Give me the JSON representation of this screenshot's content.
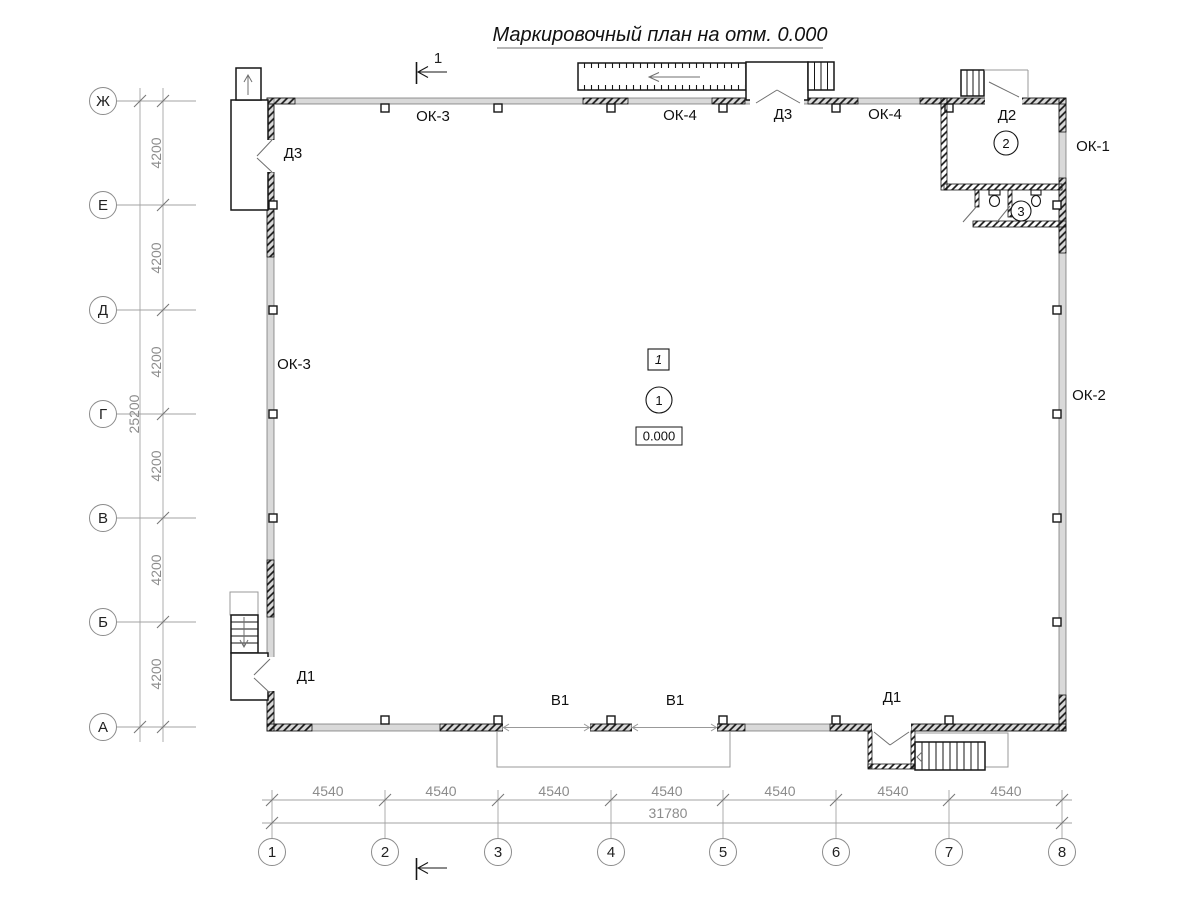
{
  "title": "Маркировочный план на отм. 0.000",
  "colors": {
    "ink": "#161616",
    "dim_gray": "#8c8c8c",
    "wall_fill": "#d9d9d9"
  },
  "axes": {
    "rows": [
      {
        "label": "Ж"
      },
      {
        "label": "Е"
      },
      {
        "label": "Д"
      },
      {
        "label": "Г"
      },
      {
        "label": "В"
      },
      {
        "label": "Б"
      },
      {
        "label": "А"
      }
    ],
    "cols": [
      {
        "label": "1"
      },
      {
        "label": "2"
      },
      {
        "label": "3"
      },
      {
        "label": "4"
      },
      {
        "label": "5"
      },
      {
        "label": "6"
      },
      {
        "label": "7"
      },
      {
        "label": "8"
      }
    ]
  },
  "dims": {
    "row_segments": [
      "4200",
      "4200",
      "4200",
      "4200",
      "4200",
      "4200"
    ],
    "row_total": "25200",
    "col_segments": [
      "4540",
      "4540",
      "4540",
      "4540",
      "4540",
      "4540",
      "4540"
    ],
    "col_total": "31780"
  },
  "labels": {
    "ok3_top": "ОК-3",
    "ok4_top_left": "ОК-4",
    "d3_top": "Д3",
    "ok4_top_right": "ОК-4",
    "d2": "Д2",
    "ok1": "ОК-1",
    "ok2": "ОК-2",
    "ok3_left": "ОК-3",
    "d3_left": "Д3",
    "d1_left": "Д1",
    "d1_bottom": "Д1",
    "v1_left": "В1",
    "v1_right": "В1"
  },
  "rooms": {
    "hall": "1",
    "vestibule": "2",
    "sanitary": "3"
  },
  "marks": {
    "section_number": "1",
    "plan_node": "1",
    "elevation": "0.000"
  }
}
